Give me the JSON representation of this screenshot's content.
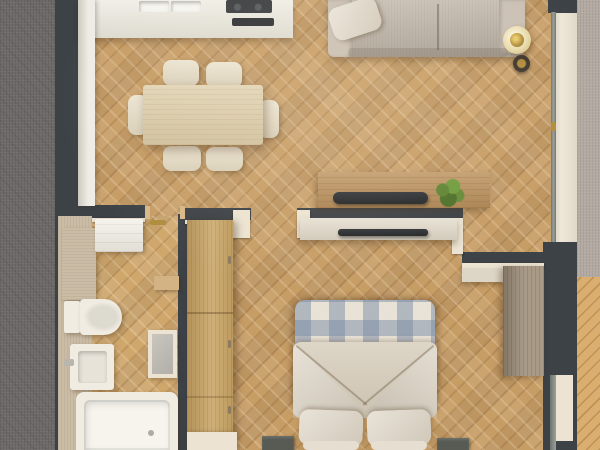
{
  "meta": {
    "type": "3d-floor-plan-render",
    "view": "top-down",
    "canvas_width": 600,
    "canvas_height": 450,
    "visible_text": "none"
  },
  "palette": {
    "wall": "#3d4247",
    "wall_cap": "#ece3d2",
    "wood_floor": "#c79d66",
    "wood_floor_light": "#cfa76d",
    "terrace_wood": "#d9ae6e",
    "balcony_gray": "#b3aaa2",
    "exterior_gray": "#6e6a69",
    "counter": "#e9e6db",
    "table": "#dbcba6",
    "chair": "#e6dcc4",
    "sofa": "#c2b8ac",
    "lamp_shade": "#e8daaa",
    "lamp_gold": "#b08d3c",
    "console_wood": "#b98e59",
    "tv_black": "#222527",
    "console_white": "#ddd5c5",
    "plant_green": "#5e8433",
    "plaid_base": "#e8e2d6",
    "plaid_blue": "#93a4ba",
    "duvet": "#d6ccba",
    "pillow": "#ddd4c4",
    "nightstand": "#585b54",
    "wardrobe_wood": "#c8a363",
    "desk_wood": "#9f8f7a",
    "fixture_white": "#f0ece2",
    "bath_beige": "#cbbda5",
    "glass": "#9aa09b"
  },
  "labels": {
    "scene": "Apartment floor plan - top-down 3D render",
    "living_room": "Living / dining room",
    "kitchen": "Kitchen",
    "bathroom": "Bathroom",
    "bedroom": "Bedroom",
    "hallway": "Hallway wardrobe area",
    "balcony": "Balcony",
    "terrace": "Terrace decking",
    "exterior": "Exterior ground",
    "sofa": "Sofa",
    "sofa_pillow": "Throw pillow",
    "floor_lamp": "Floor lamp",
    "tv_console": "TV sideboard",
    "tv": "Television",
    "plant": "Potted plant",
    "counter": "Kitchen counter",
    "sink": "Kitchen sink",
    "cooktop": "Cooktop with extractor",
    "dining_table": "Dining table",
    "chair": "Dining chair",
    "washer": "Washer cabinet",
    "bath_cabinet": "Bathroom cabinet",
    "toilet": "Toilet",
    "washbasin": "Washbasin",
    "mirror": "Mirror panel",
    "bathtub": "Bathtub",
    "towel_rail": "Brass towel rail",
    "bath_shelf": "Wall shelf",
    "wardrobe": "Wardrobe",
    "dresser": "Dresser",
    "bed": "Double bed with plaid blanket",
    "duvet": "Folded duvet",
    "pillow": "Bed pillow",
    "nightstand": "Nightstand",
    "bedroom_tv_shelf": "Bedroom TV shelf",
    "desk": "Desk cabinet",
    "window": "Bedroom window",
    "balcony_door": "Sliding balcony door"
  },
  "structure": {
    "walls_color": "#3d4247",
    "rooms": [
      {
        "name": "Living / dining / kitchen",
        "furniture": [
          "kitchen counter with sink and cooktop",
          "dining table",
          "6 dining chairs",
          "sofa with throw pillow",
          "floor lamp",
          "wooden TV sideboard with television",
          "potted plant"
        ]
      },
      {
        "name": "Bathroom",
        "furniture": [
          "washer cabinet",
          "storage cabinet",
          "toilet",
          "washbasin",
          "mirror panel",
          "bathtub",
          "towel rail",
          "wall shelf"
        ]
      },
      {
        "name": "Bedroom",
        "furniture": [
          "double bed with plaid blanket and folded duvet",
          "2 pillows",
          "2 nightstands",
          "TV shelf",
          "wardrobe",
          "dresser",
          "desk cabinet",
          "window"
        ]
      },
      {
        "name": "Balcony",
        "furniture": [
          "sliding glass door",
          "gray balcony floor",
          "wood terrace decking"
        ]
      }
    ]
  }
}
